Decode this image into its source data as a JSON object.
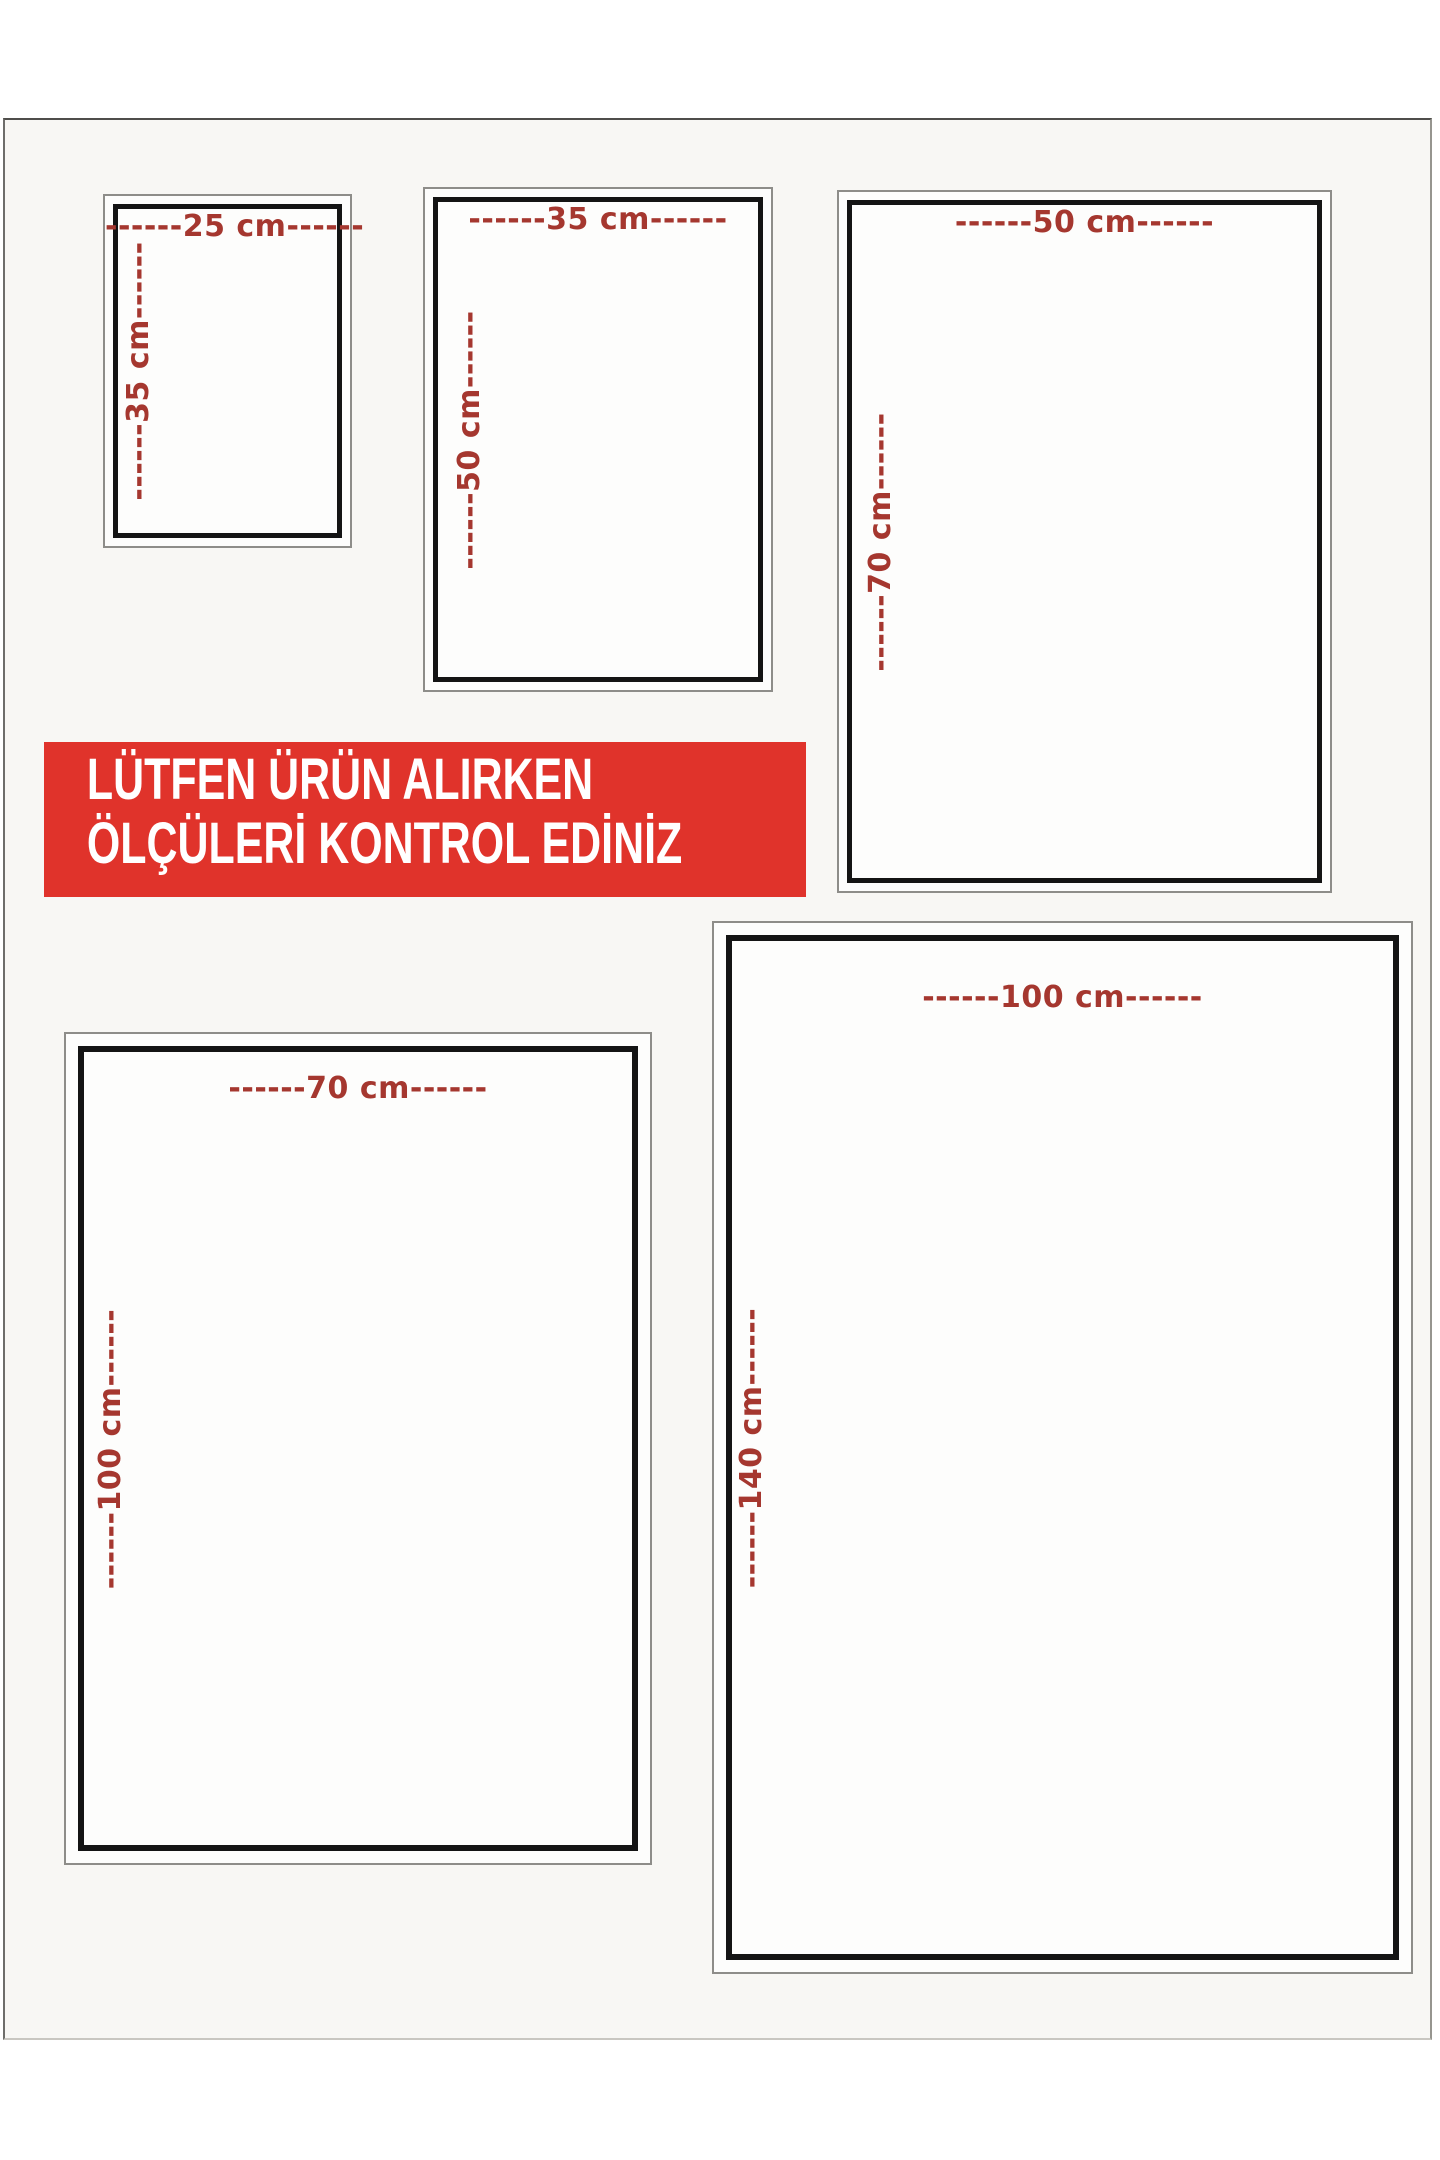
{
  "banner": {
    "line1": "LÜTFEN ÜRÜN ALIRKEN",
    "line2": "ÖLÇÜLERİ KONTROL EDİNİZ"
  },
  "sizes": [
    {
      "name": "25x35",
      "width_label": "------25 cm------",
      "height_label": "------35 cm------"
    },
    {
      "name": "35x50",
      "width_label": "------35 cm------",
      "height_label": "------50 cm------"
    },
    {
      "name": "50x70",
      "width_label": "------50 cm------",
      "height_label": "------70 cm------"
    },
    {
      "name": "70x100",
      "width_label": "------70 cm------",
      "height_label": "------100 cm------"
    },
    {
      "name": "100x140",
      "width_label": "------100 cm------",
      "height_label": "------140 cm------"
    }
  ],
  "colors": {
    "dimension_label_red": "#a5372f",
    "banner_red": "#e0332b",
    "inner_border_black": "#141414",
    "outer_border_gray": "#8e8d89"
  }
}
